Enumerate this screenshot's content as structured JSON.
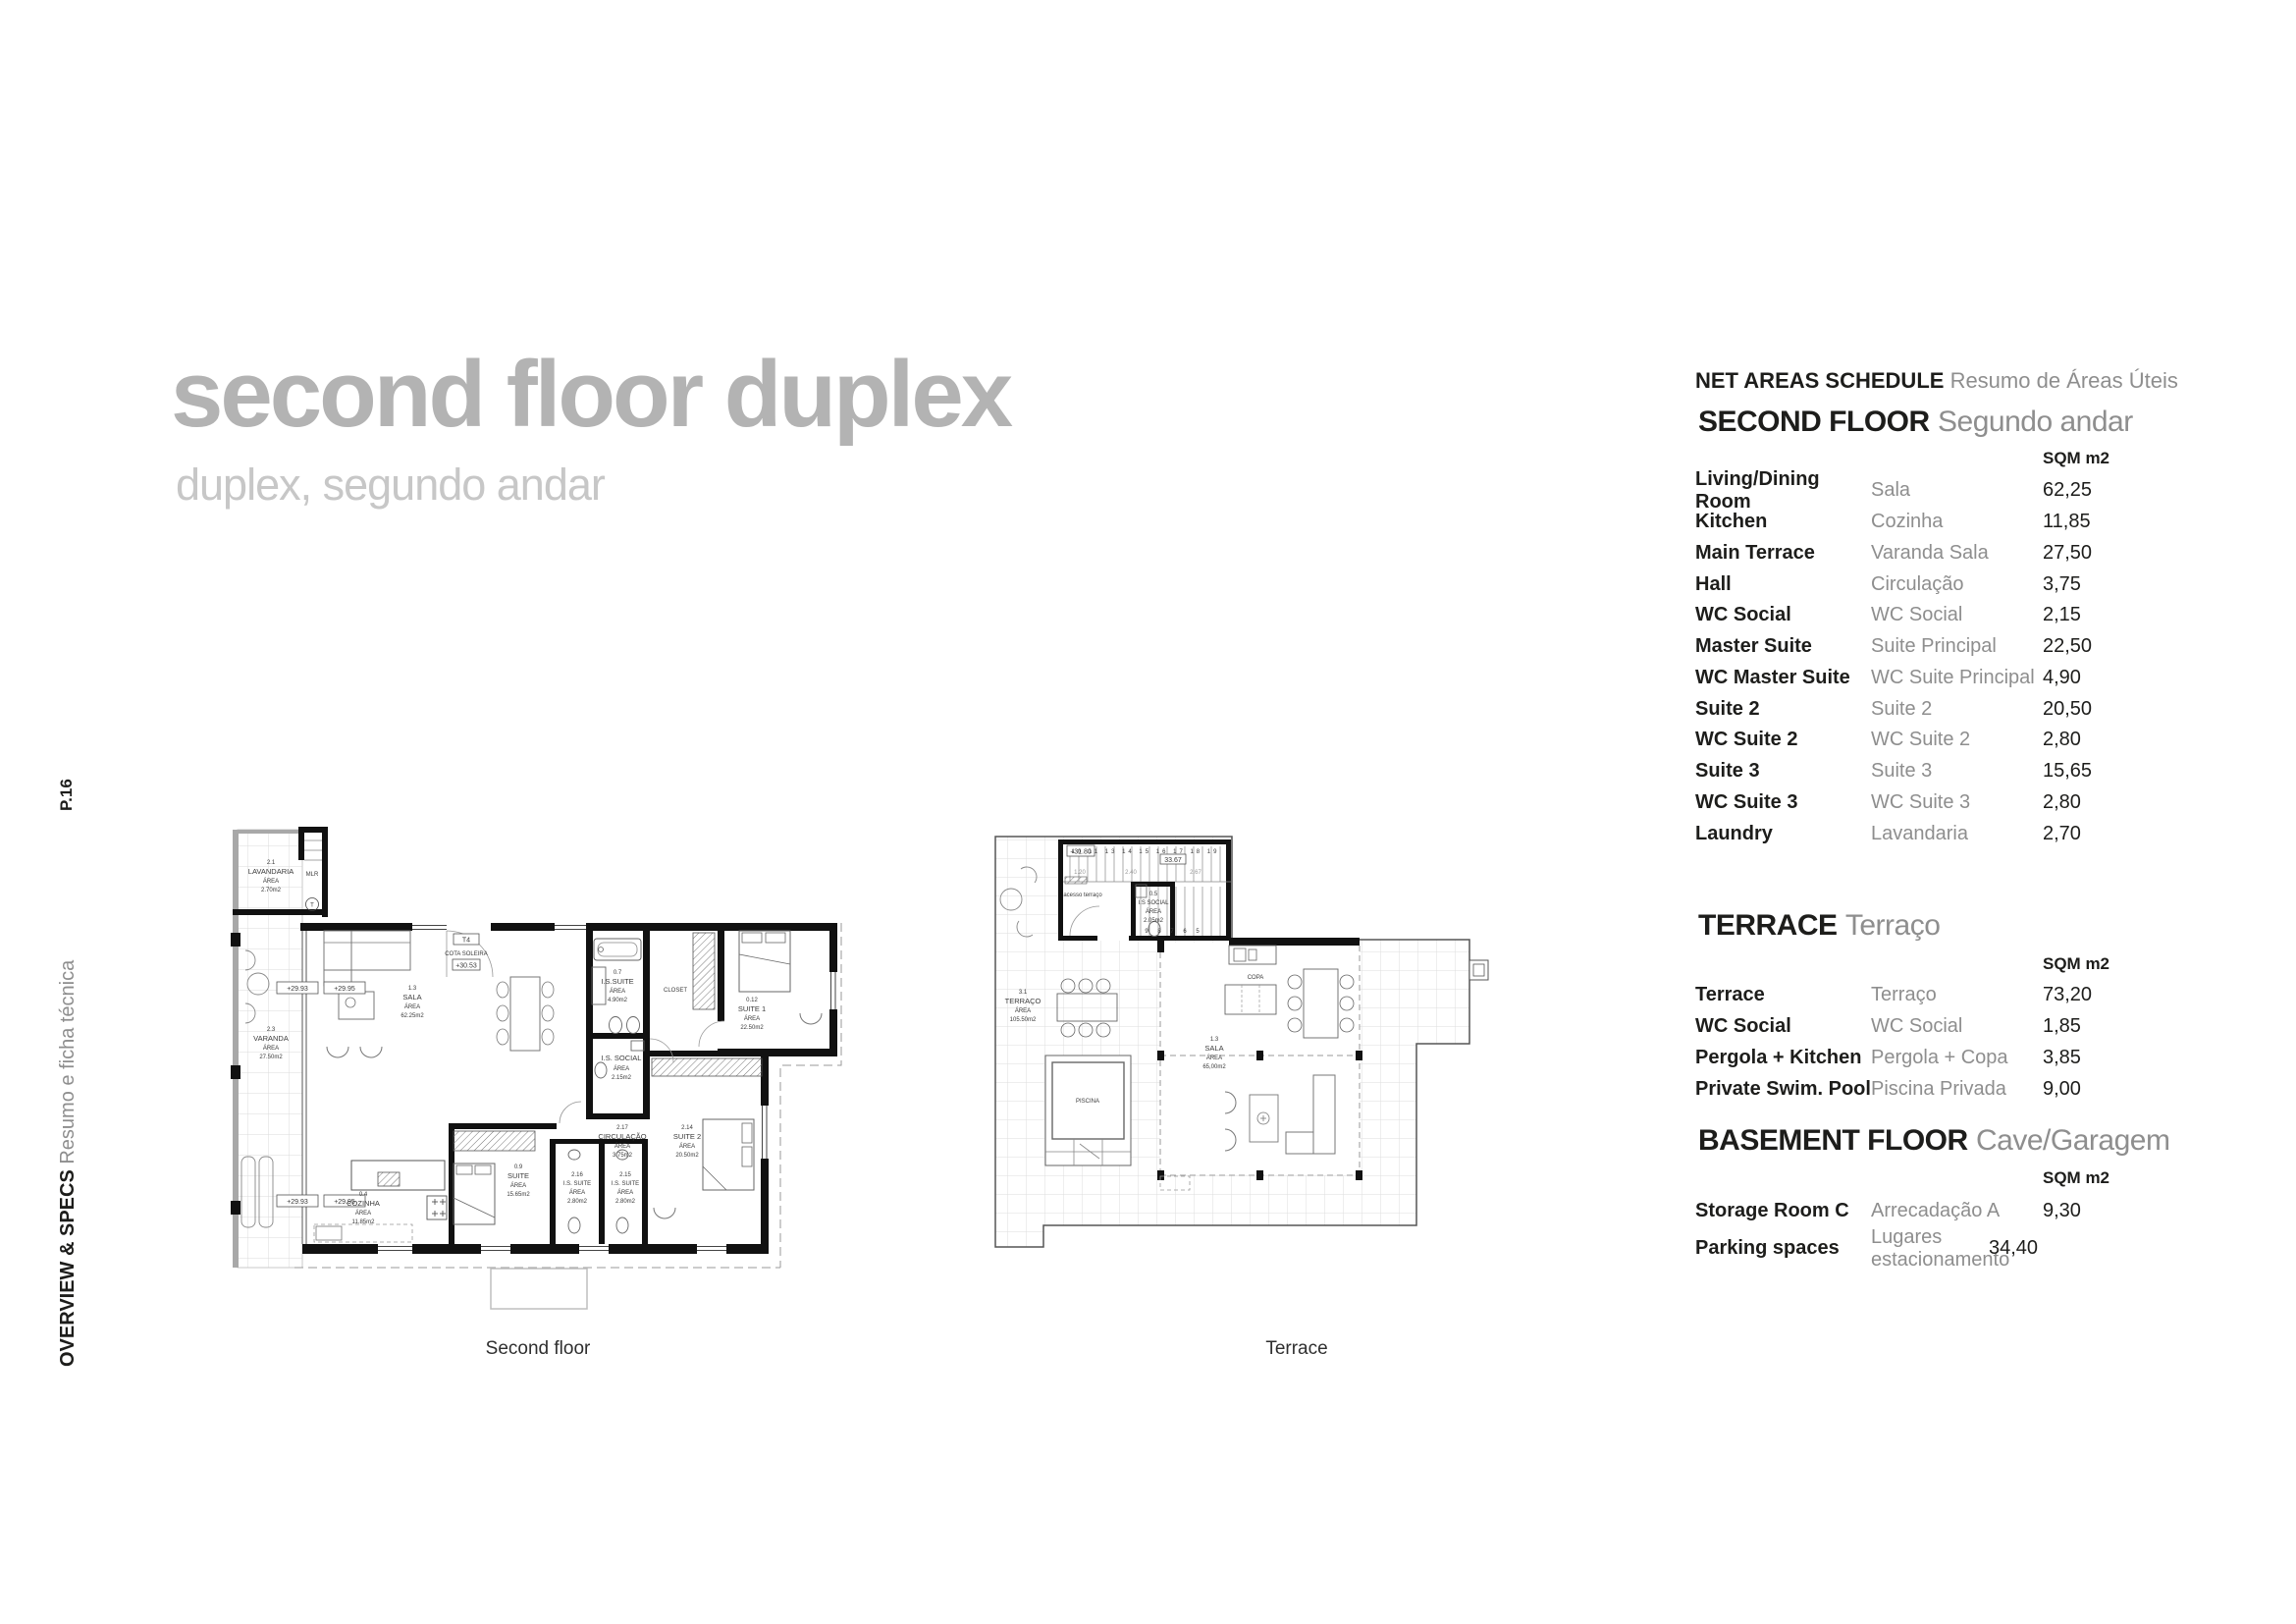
{
  "header": {
    "title": "second floor duplex",
    "subtitle": "duplex, segundo andar"
  },
  "sidebar": {
    "page": "P.16",
    "section_en": "OVERVIEW & SPECS",
    "section_pt": "Resumo e ficha técnica"
  },
  "panel": {
    "header": {
      "en": "NET AREAS SCHEDULE",
      "pt": "Resumo de Áreas Úteis"
    },
    "second_floor": {
      "title": "SECOND FLOOR",
      "subtitle": "Segundo andar",
      "sqm_header": "SQM m2",
      "rows": [
        {
          "en": "Living/Dining Room",
          "pt": "Sala",
          "sqm": "62,25"
        },
        {
          "en": "Kitchen",
          "pt": "Cozinha",
          "sqm": "11,85"
        },
        {
          "en": "Main Terrace",
          "pt": "Varanda Sala",
          "sqm": "27,50"
        },
        {
          "en": "Hall",
          "pt": "Circulação",
          "sqm": "3,75"
        },
        {
          "en": "WC Social",
          "pt": "WC Social",
          "sqm": "2,15"
        },
        {
          "en": "Master Suite",
          "pt": "Suite Principal",
          "sqm": "22,50"
        },
        {
          "en": "WC Master Suite",
          "pt": "WC Suite Principal",
          "sqm": "4,90"
        },
        {
          "en": "Suite 2",
          "pt": "Suite 2",
          "sqm": "20,50"
        },
        {
          "en": "WC Suite 2",
          "pt": "WC Suite 2",
          "sqm": "2,80"
        },
        {
          "en": "Suite 3",
          "pt": "Suite 3",
          "sqm": "15,65"
        },
        {
          "en": "WC Suite 3",
          "pt": "WC Suite 3",
          "sqm": "2,80"
        },
        {
          "en": "Laundry",
          "pt": "Lavandaria",
          "sqm": "2,70"
        }
      ]
    },
    "terrace": {
      "title": "TERRACE",
      "subtitle": "Terraço",
      "sqm_header": "SQM m2",
      "rows": [
        {
          "en": "Terrace",
          "pt": "Terraço",
          "sqm": "73,20"
        },
        {
          "en": "WC Social",
          "pt": "WC Social",
          "sqm": "1,85"
        },
        {
          "en": "Pergola + Kitchen",
          "pt": "Pergola + Copa",
          "sqm": "3,85"
        },
        {
          "en": "Private Swim. Pool",
          "pt": "Piscina Privada",
          "sqm": "9,00"
        }
      ]
    },
    "basement": {
      "title": "BASEMENT FLOOR",
      "subtitle": "Cave/Garagem",
      "sqm_header": "SQM m2",
      "rows": [
        {
          "en": "Storage Room C",
          "pt": "Arrecadação A",
          "sqm": "9,30"
        },
        {
          "en": "Parking spaces",
          "pt": "Lugares estacionamento",
          "sqm": "34,40"
        }
      ]
    }
  },
  "plans": {
    "plan1": {
      "caption": "Second floor",
      "rooms": {
        "lavandaria": {
          "num": "2.1",
          "name": "LAVANDARIA",
          "area": "ÁREA",
          "value": "2.70m2"
        },
        "mlr": "MLR",
        "t": "T",
        "sala": {
          "num": "1.3",
          "name": "SALA",
          "area": "ÁREA",
          "value": "62.25m2"
        },
        "varanda": {
          "num": "2.3",
          "name": "VARANDA",
          "area": "ÁREA",
          "value": "27.50m2"
        },
        "is_suite": {
          "num": "0.7",
          "name": "I.S.SUITE",
          "area": "ÁREA",
          "value": "4.90m2"
        },
        "closet": "CLOSET",
        "suite1": {
          "num": "0.12",
          "name": "SUITE 1",
          "area": "ÁREA",
          "value": "22.50m2"
        },
        "is_social": {
          "name": "I.S. SOCIAL",
          "area": "ÁREA",
          "value": "2.15m2"
        },
        "circulacao": {
          "num": "2.17",
          "name": "CIRCULAÇÃO",
          "area": "ÁREA",
          "value": "3.75m2"
        },
        "cozinha": {
          "num": "0.4",
          "name": "COZINHA",
          "area": "ÁREA",
          "value": "11.85m2"
        },
        "suite09": {
          "num": "0.9",
          "name": "SUITE",
          "area": "ÁREA",
          "value": "15.65m2"
        },
        "is_suite216": {
          "num": "2.16",
          "name": "I.S. SUITE",
          "area": "ÁREA",
          "value": "2.80m2"
        },
        "is_suite215": {
          "num": "2.15",
          "name": "I.S. SUITE",
          "area": "ÁREA",
          "value": "2.80m2"
        },
        "suite2": {
          "num": "2.14",
          "name": "SUITE 2",
          "area": "ÁREA",
          "value": "20.50m2"
        }
      },
      "markers": {
        "t4": "T4",
        "cota": "COTA SOLEIRA",
        "cota_value": "+30.53",
        "elev1": "+29.93",
        "elev2": "+29.95",
        "elev3": "+29.93",
        "elev4": "+29.95"
      }
    },
    "plan2": {
      "caption": "Terrace",
      "rooms": {
        "terraco": {
          "num": "3.1",
          "name": "TERRAÇO",
          "area": "ÁREA",
          "value": "105.50m2"
        },
        "is_social": {
          "num": "0.5",
          "name": "I.S SOCIAL",
          "area": "ÁREA",
          "value": "2.05m2"
        },
        "sala": {
          "num": "1.3",
          "name": "SALA",
          "area": "ÁREA",
          "value": "65,00m2"
        },
        "copa": "COPA",
        "piscina": "PISCINA",
        "acesso": "acesso terraço"
      },
      "markers": {
        "elev": "+31.80",
        "dim_top": "33.67",
        "d1": "1.20",
        "d2": "2.40",
        "d3": "2.67",
        "steps_up": "10 11 13 14 15 16 17 18 19",
        "steps_down": "9 8 7 6 5"
      }
    }
  }
}
